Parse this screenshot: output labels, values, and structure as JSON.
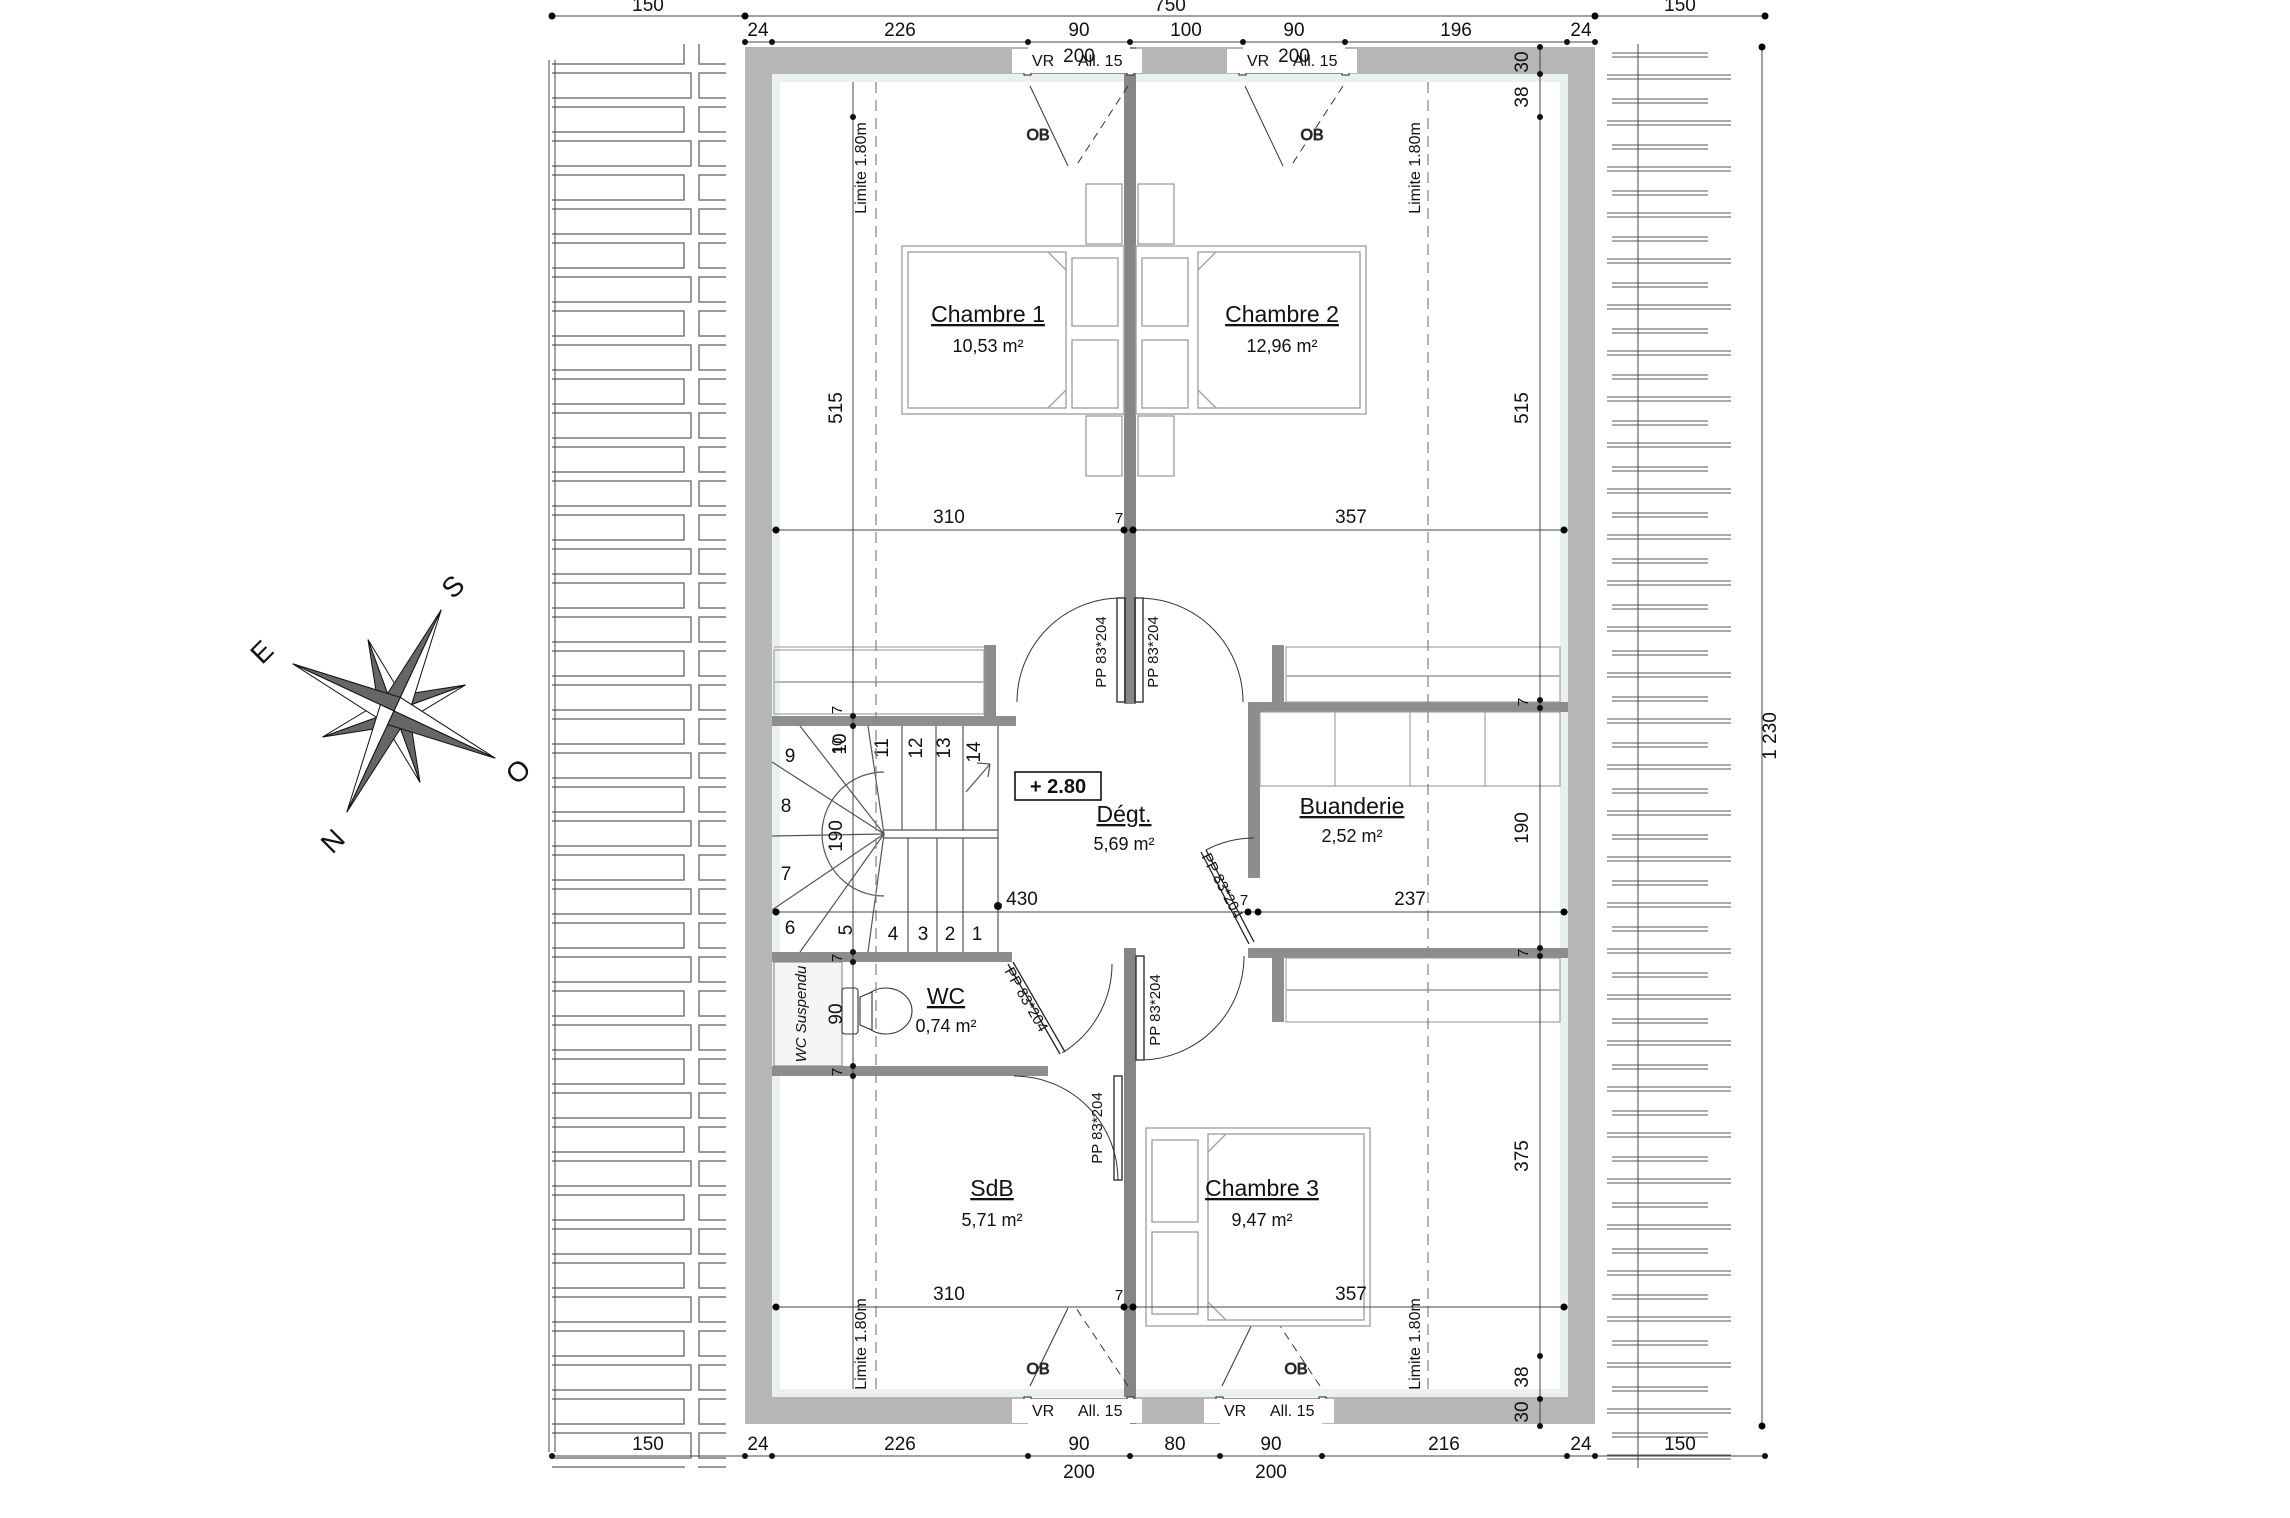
{
  "rooms": {
    "chambre1": {
      "name": "Chambre 1",
      "area": "10,53 m²"
    },
    "chambre2": {
      "name": "Chambre 2",
      "area": "12,96 m²"
    },
    "chambre3": {
      "name": "Chambre 3",
      "area": "9,47 m²"
    },
    "degagement": {
      "name": "Dégt.",
      "area": "5,69 m²"
    },
    "buanderie": {
      "name": "Buanderie",
      "area": "2,52 m²"
    },
    "wc": {
      "name": "WC",
      "area": "0,74 m²"
    },
    "sdb": {
      "name": "SdB",
      "area": "5,71 m²"
    }
  },
  "labels": {
    "wc_suspendu": "WC Suspendu",
    "level": "+ 2.80",
    "door": "PP 83*204",
    "window_vr": "VR",
    "window_allege": "All. 15",
    "window_ob": "OB",
    "limite": "Limite 1.80m"
  },
  "compass": {
    "n": "N",
    "s": "S",
    "e": "E",
    "o": "O"
  },
  "stairs": {
    "steps": [
      "1",
      "2",
      "3",
      "4",
      "5",
      "6",
      "7",
      "8",
      "9",
      "10",
      "11",
      "12",
      "13",
      "14"
    ]
  },
  "dimensions": {
    "top_overall": [
      "150",
      "750",
      "150"
    ],
    "top_segments": [
      "24",
      "226",
      "90",
      "200",
      "100",
      "90",
      "200",
      "196",
      "24"
    ],
    "bottom_segments": [
      "150",
      "24",
      "226",
      "90",
      "200",
      "80",
      "90",
      "200",
      "216",
      "24",
      "150"
    ],
    "right_chain": [
      "30",
      "38",
      "515",
      "7",
      "190",
      "7",
      "375",
      "38",
      "30"
    ],
    "right_overall": "1 230",
    "left_chain": [
      "515",
      "7",
      "10",
      "190",
      "7",
      "90",
      "7"
    ],
    "mid_row": [
      "310",
      "7",
      "357"
    ],
    "hall_row": [
      "430",
      "7",
      "237"
    ]
  }
}
